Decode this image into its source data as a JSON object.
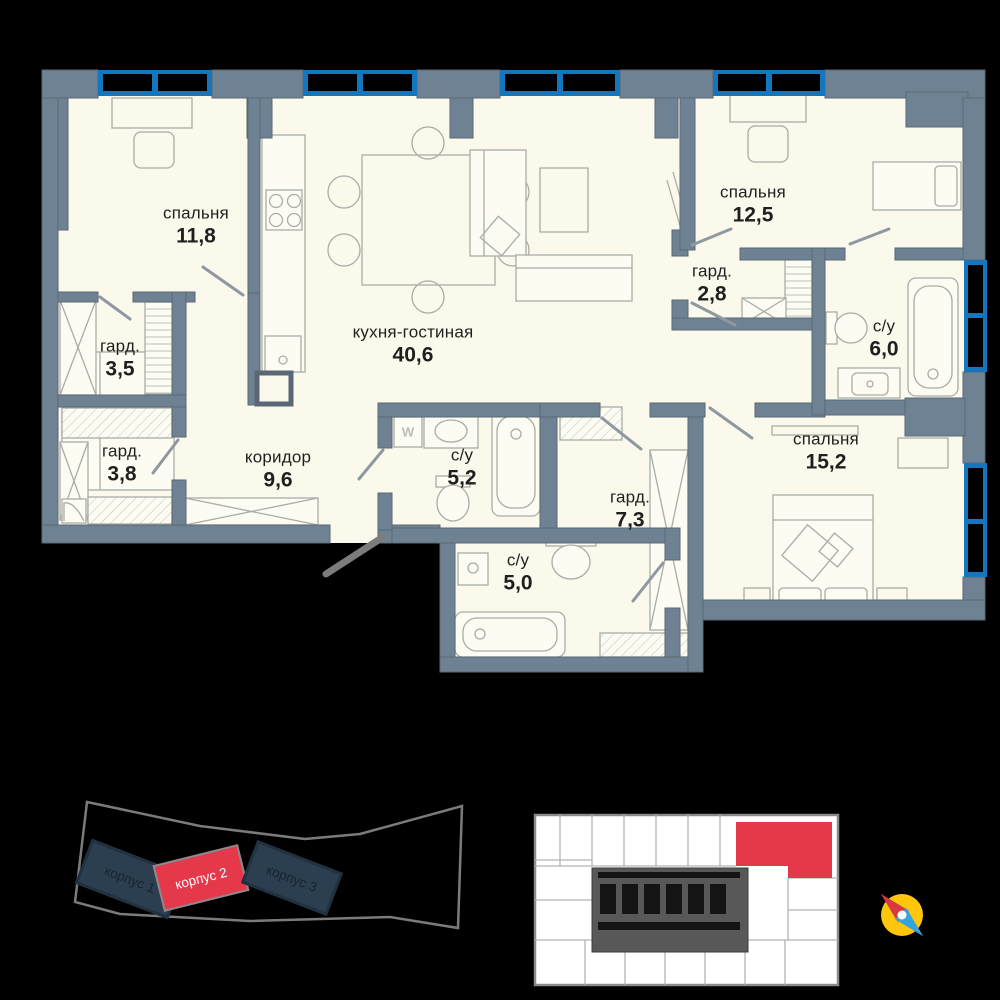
{
  "floor_plan": {
    "rooms": [
      {
        "name": "спальня",
        "area": "11,8"
      },
      {
        "name": "гард.",
        "area": "3,5"
      },
      {
        "name": "гард.",
        "area": "3,8"
      },
      {
        "name": "коридор",
        "area": "9,6"
      },
      {
        "name": "кухня-гостиная",
        "area": "40,6"
      },
      {
        "name": "с/у",
        "area": "5,2"
      },
      {
        "name": "с/у",
        "area": "5,0"
      },
      {
        "name": "гард.",
        "area": "7,3"
      },
      {
        "name": "спальня",
        "area": "12,5"
      },
      {
        "name": "гард.",
        "area": "2,8"
      },
      {
        "name": "с/у",
        "area": "6,0"
      },
      {
        "name": "спальня",
        "area": "15,2"
      }
    ],
    "washer_label": "W"
  },
  "site_plan": {
    "buildings": [
      {
        "label": "корпус 1",
        "highlighted": false
      },
      {
        "label": "корпус 2",
        "highlighted": true
      },
      {
        "label": "корпус 3",
        "highlighted": false
      }
    ]
  },
  "colors": {
    "wall": "#6e8294",
    "floor": "#fbf9ec",
    "window": "#1476bd",
    "highlight": "#e5394b",
    "building_dark": "#2c3f50",
    "compass_yellow": "#ffc60b"
  }
}
